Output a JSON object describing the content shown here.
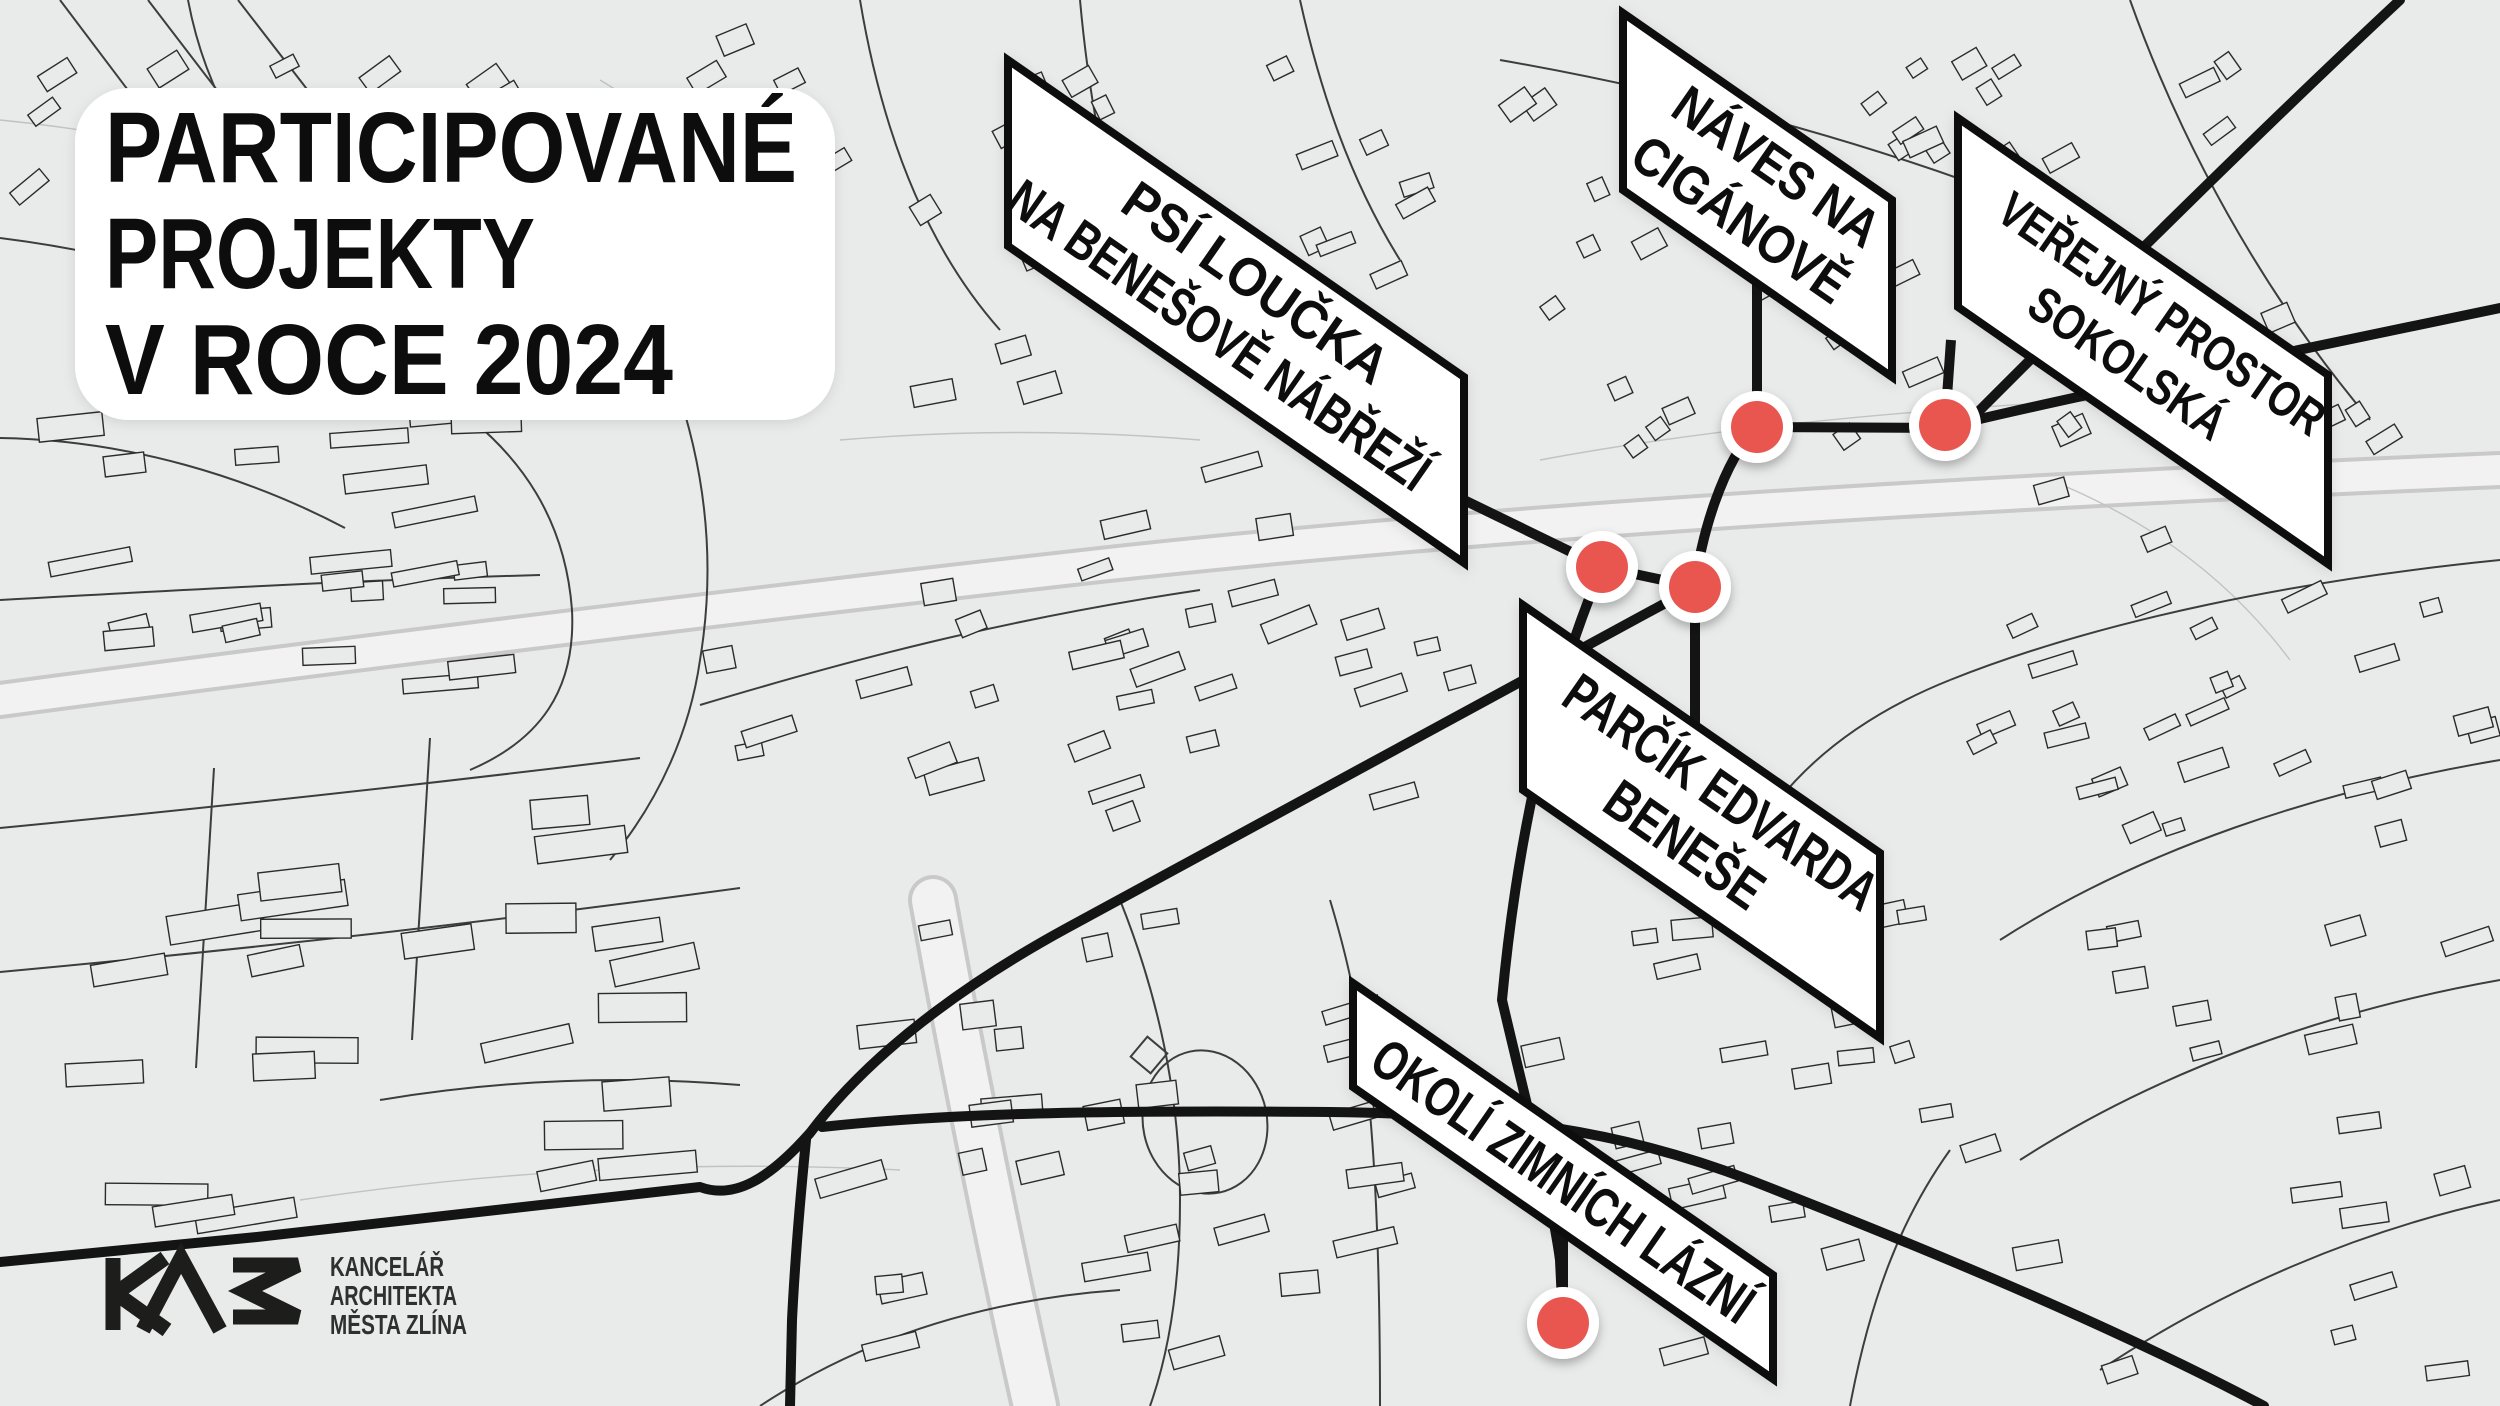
{
  "title": {
    "lines": [
      "PARTICIPOVANÉ",
      "PROJEKTY",
      "V ROCE 2024"
    ]
  },
  "labels": [
    {
      "id": "psi-loucka",
      "lines": [
        "PSÍ LOUČKA",
        "NA BENEŠOVĚ NÁBŘEŽÍ"
      ]
    },
    {
      "id": "naves",
      "lines": [
        "NÁVES NA",
        "CIGÁNOVĚ"
      ]
    },
    {
      "id": "sokolska",
      "lines": [
        "VEŘEJNÝ PROSTOR",
        "SOKOLSKÁ"
      ]
    },
    {
      "id": "parcik",
      "lines": [
        "PARČÍK EDVARDA",
        "BENEŠE"
      ]
    },
    {
      "id": "okoli",
      "lines": [
        "OKOLÍ ZIMNÍCH LÁZNÍ"
      ]
    }
  ],
  "logo": {
    "mark": "KAM",
    "text_lines": [
      "KANCELÁŘ",
      "ARCHITEKTA",
      "MĚSTA ZLÍNA"
    ]
  },
  "markers": {
    "count": 5,
    "color": "#e95750",
    "ring_color": "#ffffff"
  },
  "colors": {
    "background": "#e9eaea",
    "road": "#141414",
    "label_fill": "#ffffff",
    "label_border": "#111111",
    "accent_red": "#e95750"
  }
}
